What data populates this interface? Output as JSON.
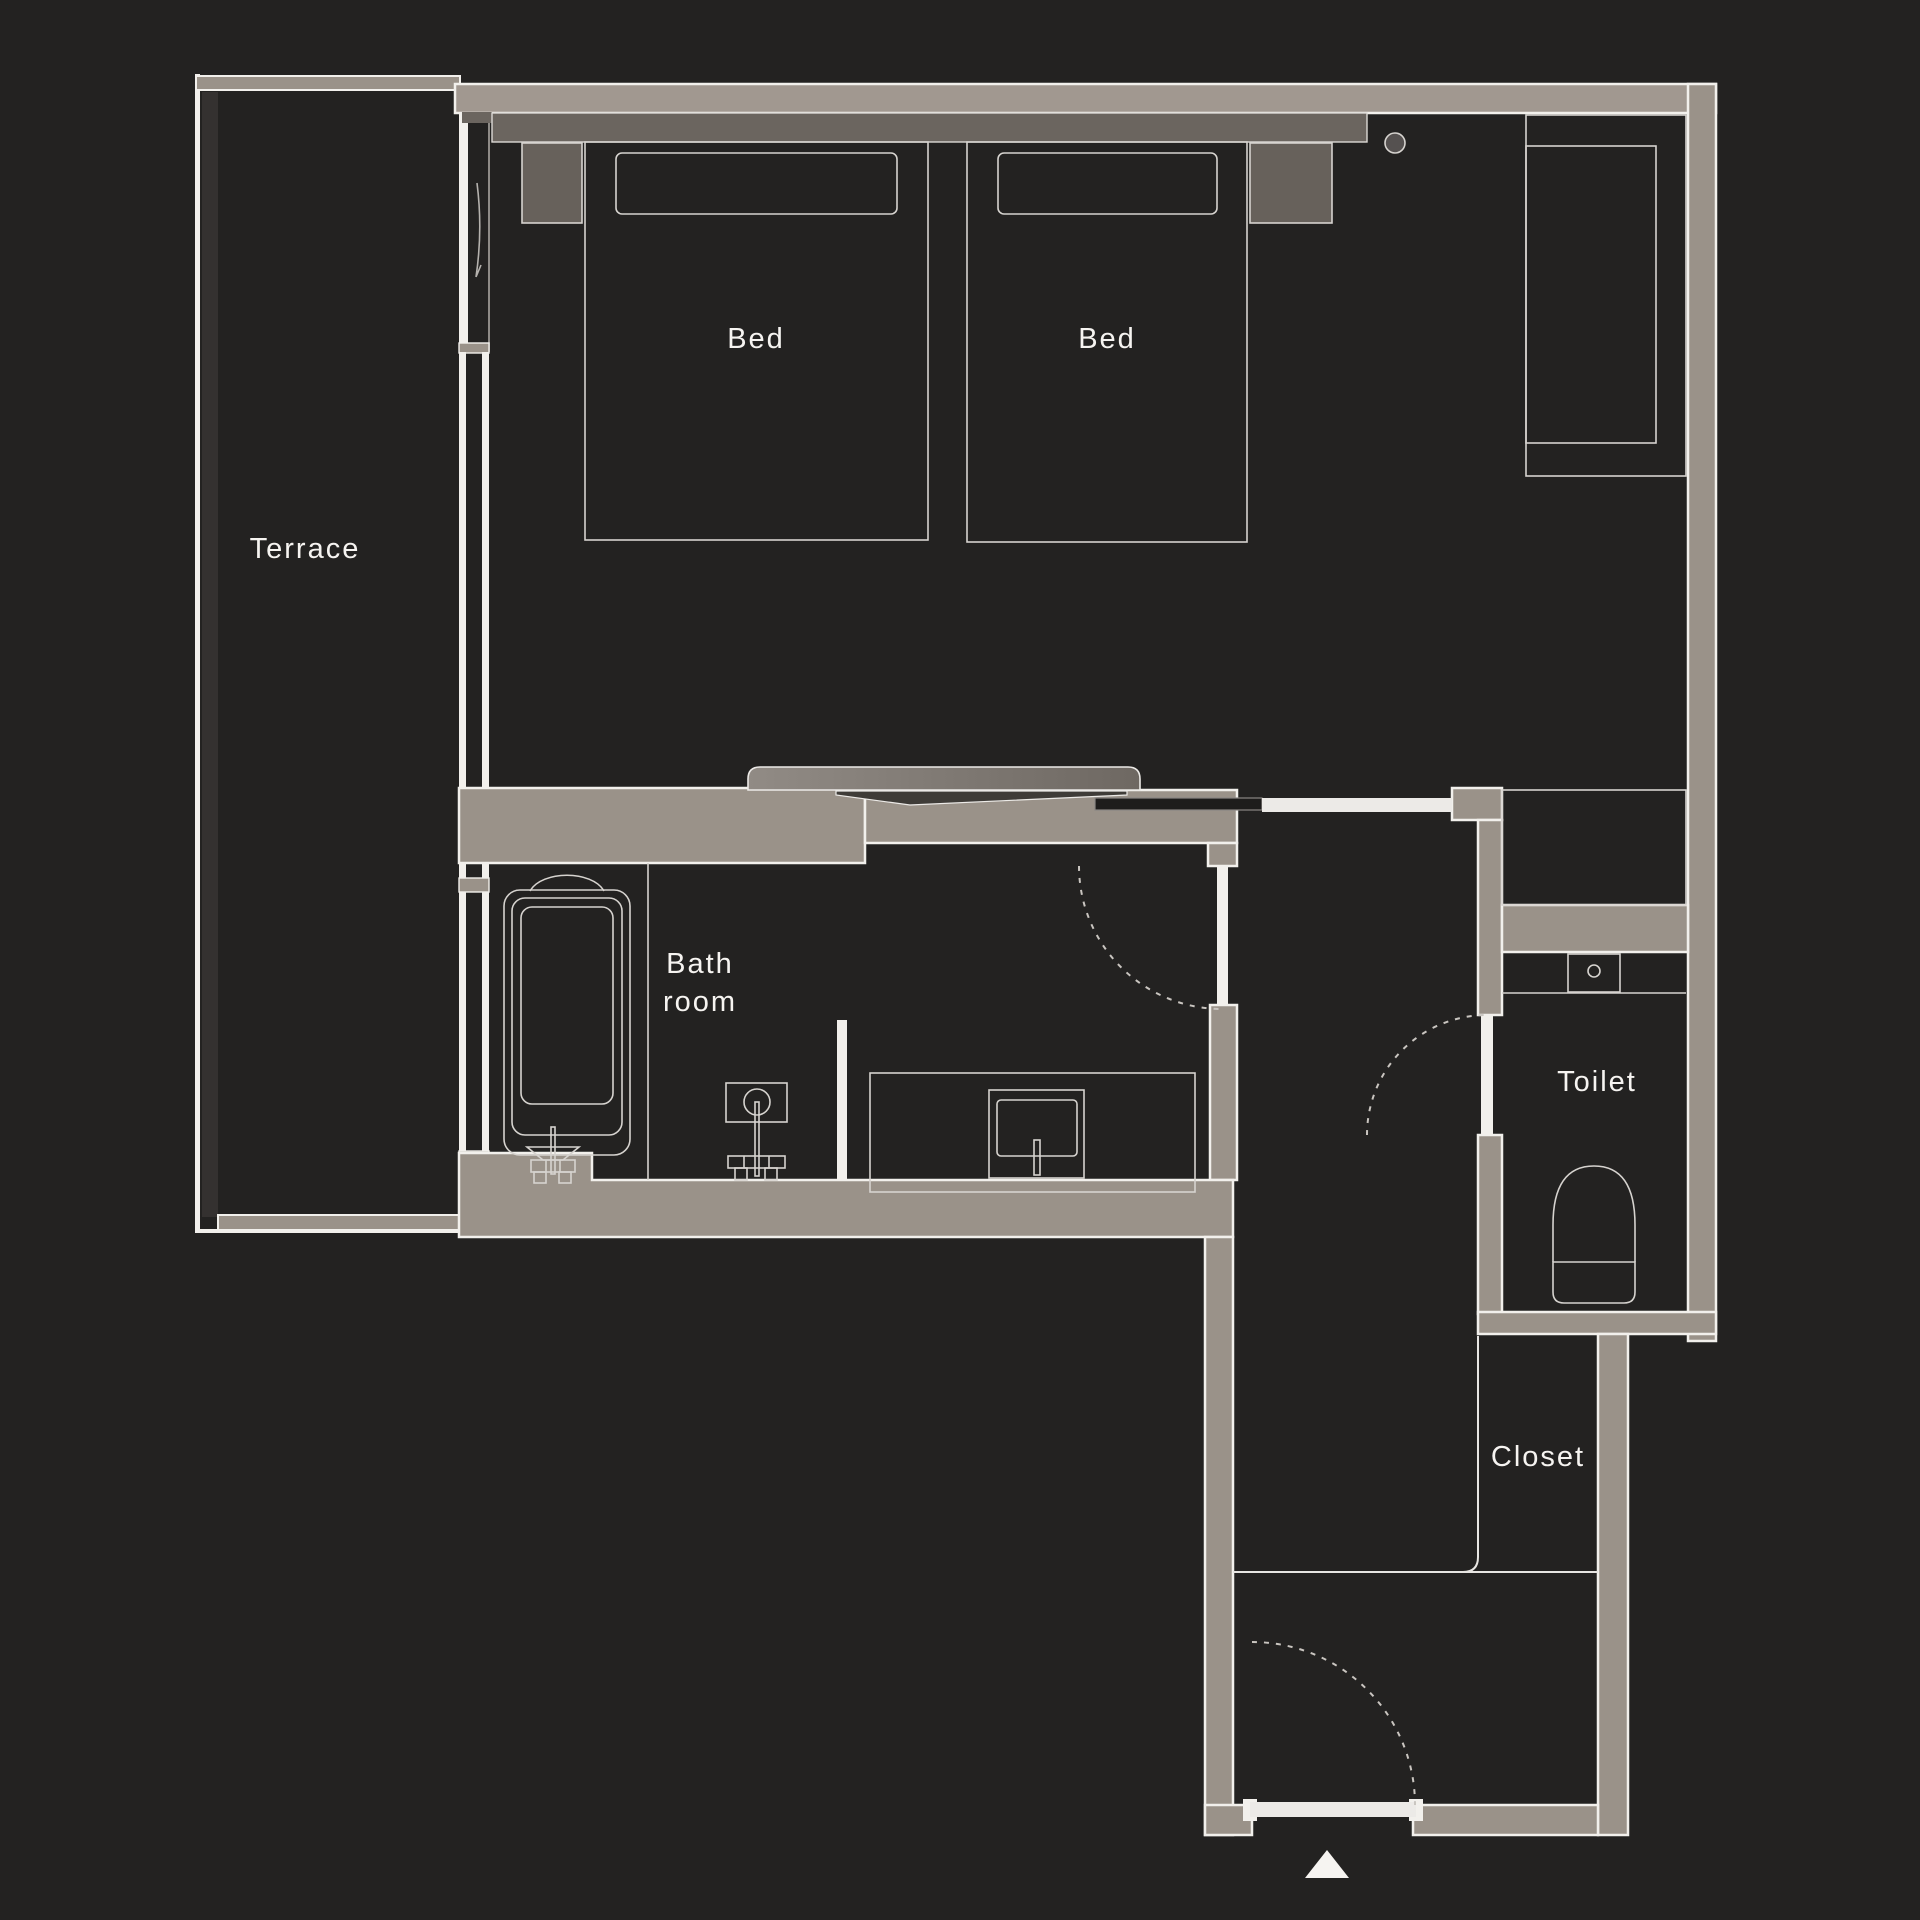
{
  "labels": {
    "terrace": "Terrace",
    "bed_left": "Bed",
    "bed_right": "Bed",
    "bath_line1": "Bath",
    "bath_line2": "room",
    "toilet": "Toilet",
    "closet": "Closet"
  },
  "colors": {
    "background": "#232221",
    "wall": "#9a9289",
    "wall_light": "#a19890",
    "headboard": "#6b655f",
    "nightstand": "#67615b",
    "outline_white": "#f2f0ec",
    "thin_line": "#d6d3cf",
    "dashed_line": "#c9c5c0",
    "text": "#f6f4f1"
  },
  "symbols": [
    "double-bed",
    "single-bed",
    "pillow",
    "nightstand",
    "ceiling-light",
    "desk-counter",
    "tv-console",
    "bathtub",
    "bath-faucet",
    "shower-mixer",
    "vanity-counter",
    "wash-basin",
    "toilet-bowl",
    "toilet-sink",
    "door-swing-arc",
    "entry-arrow"
  ]
}
